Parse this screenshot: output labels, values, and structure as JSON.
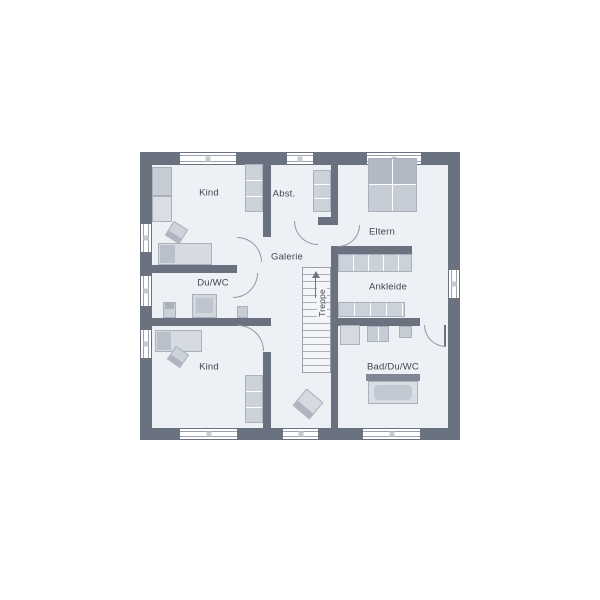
{
  "labels": {
    "kind_top": "Kind",
    "abst": "Abst.",
    "eltern": "Eltern",
    "galerie": "Galerie",
    "du_wc": "Du/WC",
    "ankleide": "Ankleide",
    "treppe": "Treppe",
    "kind_bottom": "Kind",
    "bad_du_wc": "Bad/Du/WC"
  },
  "colors": {
    "wall": "#6a7280",
    "floor": "#edf0f4",
    "furniture": "#ccd2da",
    "furniture_dark": "#b2b9c4",
    "text": "#3f4650",
    "window": "#ffffff"
  }
}
